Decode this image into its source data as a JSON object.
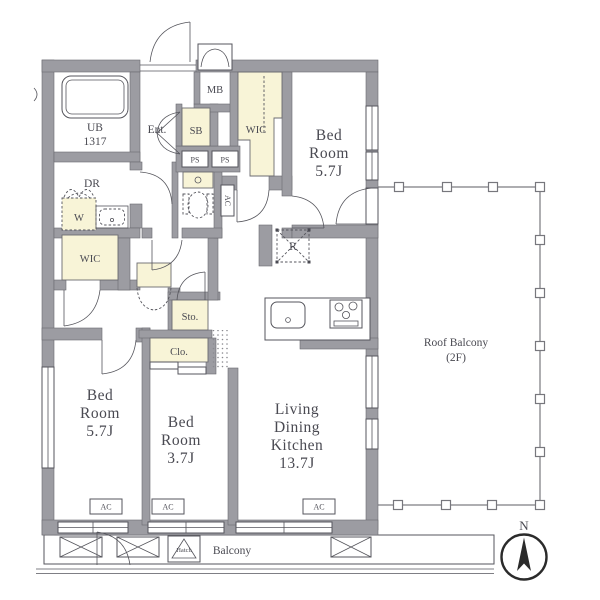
{
  "colors": {
    "wall": "#9c9ca2",
    "wall_edge": "#6b6b71",
    "cream": "#f8f4d7",
    "line": "#55555c",
    "text": "#4a4a52",
    "bg": "#ffffff"
  },
  "rooms": {
    "ub": {
      "lines": [
        "UB",
        "1317"
      ]
    },
    "entrance": {
      "label": "Ent."
    },
    "meter_box": {
      "label": "MB"
    },
    "shoe_box": {
      "label": "SB"
    },
    "wic_upper": {
      "label": "WIC"
    },
    "bedroom_ne": {
      "lines": [
        "Bed",
        "Room",
        "5.7J"
      ]
    },
    "dressing_room": {
      "label": "DR"
    },
    "washer": {
      "label": "W"
    },
    "wic_west": {
      "label": "WIC"
    },
    "storage": {
      "label": "Sto."
    },
    "closet": {
      "label": "Clo."
    },
    "bedroom_sw": {
      "lines": [
        "Bed",
        "Room",
        "5.7J"
      ]
    },
    "bedroom_s": {
      "lines": [
        "Bed",
        "Room",
        "3.7J"
      ]
    },
    "ldk": {
      "lines": [
        "Living",
        "Dining",
        "Kitchen",
        "13.7J"
      ]
    },
    "roof_balcony": {
      "lines": [
        "Roof Balcony",
        "(2F)"
      ]
    },
    "balcony": {
      "label": "Balcony"
    },
    "hatch": {
      "label": "Hatch"
    }
  },
  "fixtures": {
    "pipe_space": "PS",
    "air_conditioner": "AC",
    "refrigerator": "R"
  },
  "compass": {
    "north": "N"
  }
}
